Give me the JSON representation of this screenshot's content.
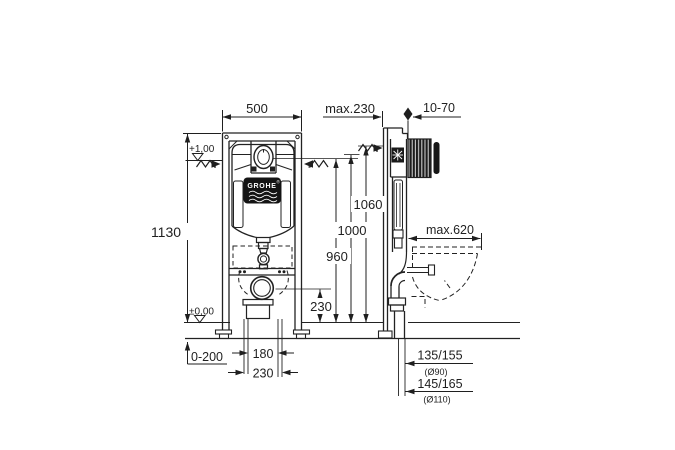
{
  "drawing": {
    "brand": "GROHE",
    "registered": "®",
    "dims": {
      "top_width": "500",
      "bracket_max": "max.230",
      "wall_thickness_range": "10-70",
      "frame_height": "1130",
      "level_plus_one": "+1,00",
      "level_zero": "±0,00",
      "height_1060": "1060",
      "height_1000": "1000",
      "height_960": "960",
      "drain_height": "230",
      "floor_buildup_range": "0-200",
      "pipe_spacing": "180",
      "outlet_offset": "230",
      "bowl_depth_max": "max.620",
      "outlet_height_90": "135/155",
      "outlet_dia_90": "(Ø90)",
      "outlet_height_110": "145/165",
      "outlet_dia_110": "(Ø110)"
    }
  }
}
